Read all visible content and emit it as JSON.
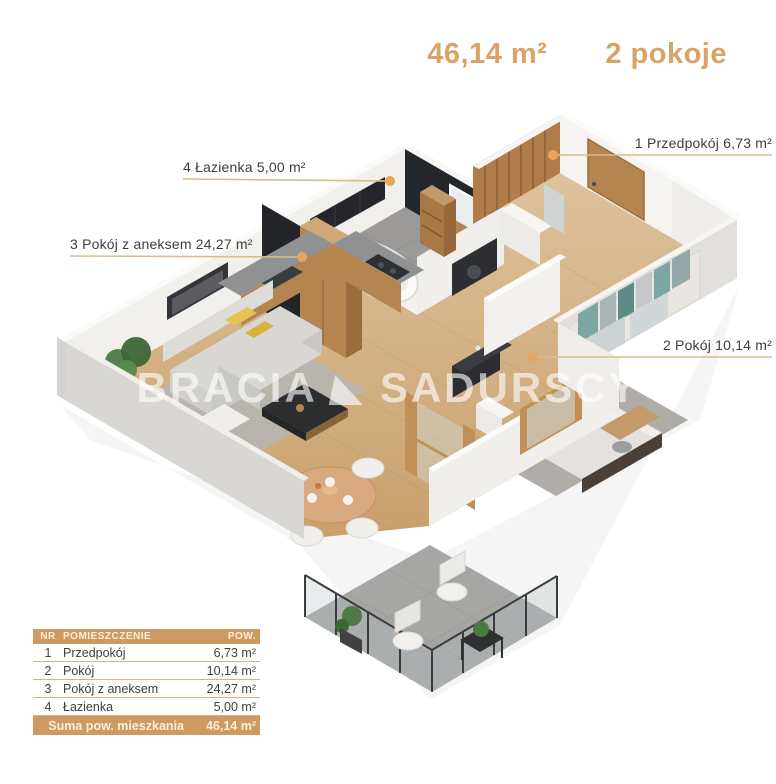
{
  "header": {
    "total_area": "46,14 m²",
    "rooms": "2 pokoje"
  },
  "watermark": {
    "brand_left": "BRACIA",
    "brand_right": "SADURSCY"
  },
  "room_labels": [
    {
      "id": "1",
      "text": "1 Przedpokój 6,73 m²"
    },
    {
      "id": "2",
      "text": "2 Pokój 10,14 m²"
    },
    {
      "id": "3",
      "text": "3 Pokój z aneksem 24,27 m²"
    },
    {
      "id": "4",
      "text": "4 Łazienka 5,00 m²"
    }
  ],
  "table": {
    "headers": {
      "nr": "NR",
      "room": "POMIESZCZENIE",
      "area": "POW."
    },
    "rows": [
      {
        "nr": "1",
        "room": "Przedpokój",
        "area": "6,73 m²"
      },
      {
        "nr": "2",
        "room": "Pokój",
        "area": "10,14 m²"
      },
      {
        "nr": "3",
        "room": "Pokój z aneksem",
        "area": "24,27 m²"
      },
      {
        "nr": "4",
        "room": "Łazienka",
        "area": "5,00 m²"
      }
    ],
    "footer": {
      "label": "Suma pow. mieszkania",
      "value": "46,14 m²"
    }
  },
  "colors": {
    "accent": "#dba268",
    "table_band": "#ce9a61",
    "leader_line": "#d8bd92",
    "marker_dot": "#e8a55a",
    "label_text": "#3e3e3e",
    "dark_wall": "#23262b",
    "wood": "#b5854f"
  }
}
